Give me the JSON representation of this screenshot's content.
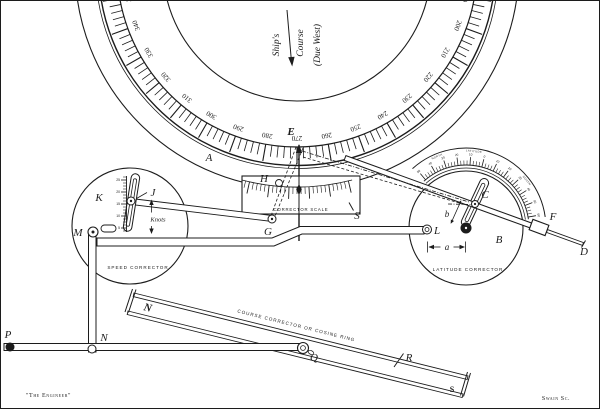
{
  "labels": {
    "A": "A",
    "B": "B",
    "C": "C",
    "D": "D",
    "E": "E",
    "F": "F",
    "G": "G",
    "H": "H",
    "J": "J",
    "K": "K",
    "L": "L",
    "M": "M",
    "N_link": "N",
    "N_ring": "N",
    "P": "P",
    "Q": "Q",
    "R": "R",
    "S_scale": "S",
    "S_ring": "S",
    "a": "a",
    "b": "b"
  },
  "ships_course": {
    "word1": "Ship's",
    "word2": "Course",
    "word3": "(Due West)"
  },
  "captions": {
    "corrector_scale": "CORRECTOR SCALE",
    "speed_corrector": "SPEED CORRECTOR",
    "latitude_corrector": "LATITUDE CORRECTOR",
    "cosine_ring": "COURSE CORRECTOR OR COSINE RING",
    "knots": "Knots"
  },
  "credits": {
    "left": "\"The Engineer\"",
    "right": "Swain Sc."
  },
  "scales": {
    "compass": {
      "unit": "degrees",
      "label_start": 190,
      "label_end": 350,
      "label_step": 10,
      "tick_start": 184,
      "tick_end": 356,
      "tick_step": 2,
      "pointer_value": 270
    },
    "latitude": {
      "values": [
        "50",
        "40",
        "30",
        "20",
        "10",
        "0",
        "10",
        "20",
        "30",
        "40",
        "50",
        "60"
      ],
      "words": [
        "NORTH",
        "LATITUDE",
        "SOUTH"
      ]
    },
    "knots": {
      "values": [
        "25",
        "20",
        "15",
        "10",
        "5"
      ]
    }
  },
  "colors": {
    "ink": "#1c1c1c",
    "paper": "#ffffff"
  }
}
